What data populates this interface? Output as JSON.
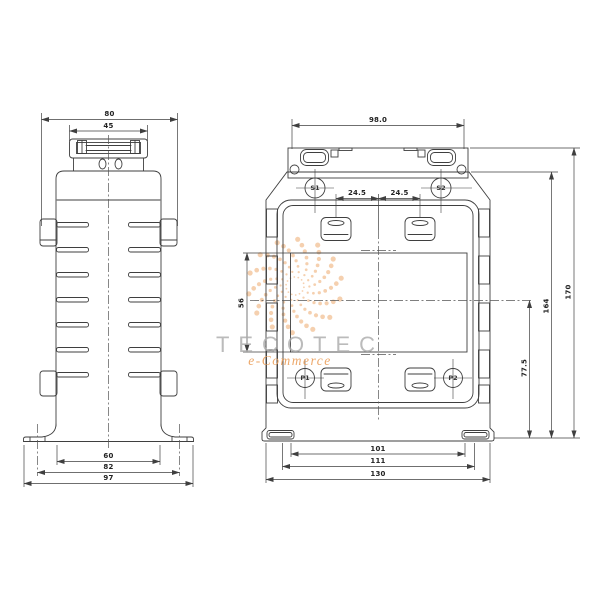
{
  "drawing": {
    "type": "technical-dimension-drawing",
    "line_color": "#3f3f3f",
    "background": "#ffffff",
    "watermark": {
      "brand": "TECOTEC",
      "sub": "e-Commerce",
      "accent": "#eca361",
      "text_color": "#ababab"
    },
    "side_view": {
      "dims": {
        "overall_width": "80",
        "cap_width": "45",
        "base_width": "60",
        "slot_spacing": "82",
        "flange_width": "97"
      }
    },
    "front_view": {
      "dims": {
        "bracket_width": "98.0",
        "terminal_offset_left": "24.5",
        "terminal_offset_right": "24.5",
        "window_height": "56",
        "center_to_base": "77.5",
        "body_height": "164",
        "overall_height": "170",
        "slot_inner_span": "101",
        "slot_outer_span": "111",
        "base_width": "130"
      },
      "terminals": {
        "s1": "S1",
        "s2": "S2",
        "p1": "P1",
        "p2": "P2"
      }
    }
  }
}
